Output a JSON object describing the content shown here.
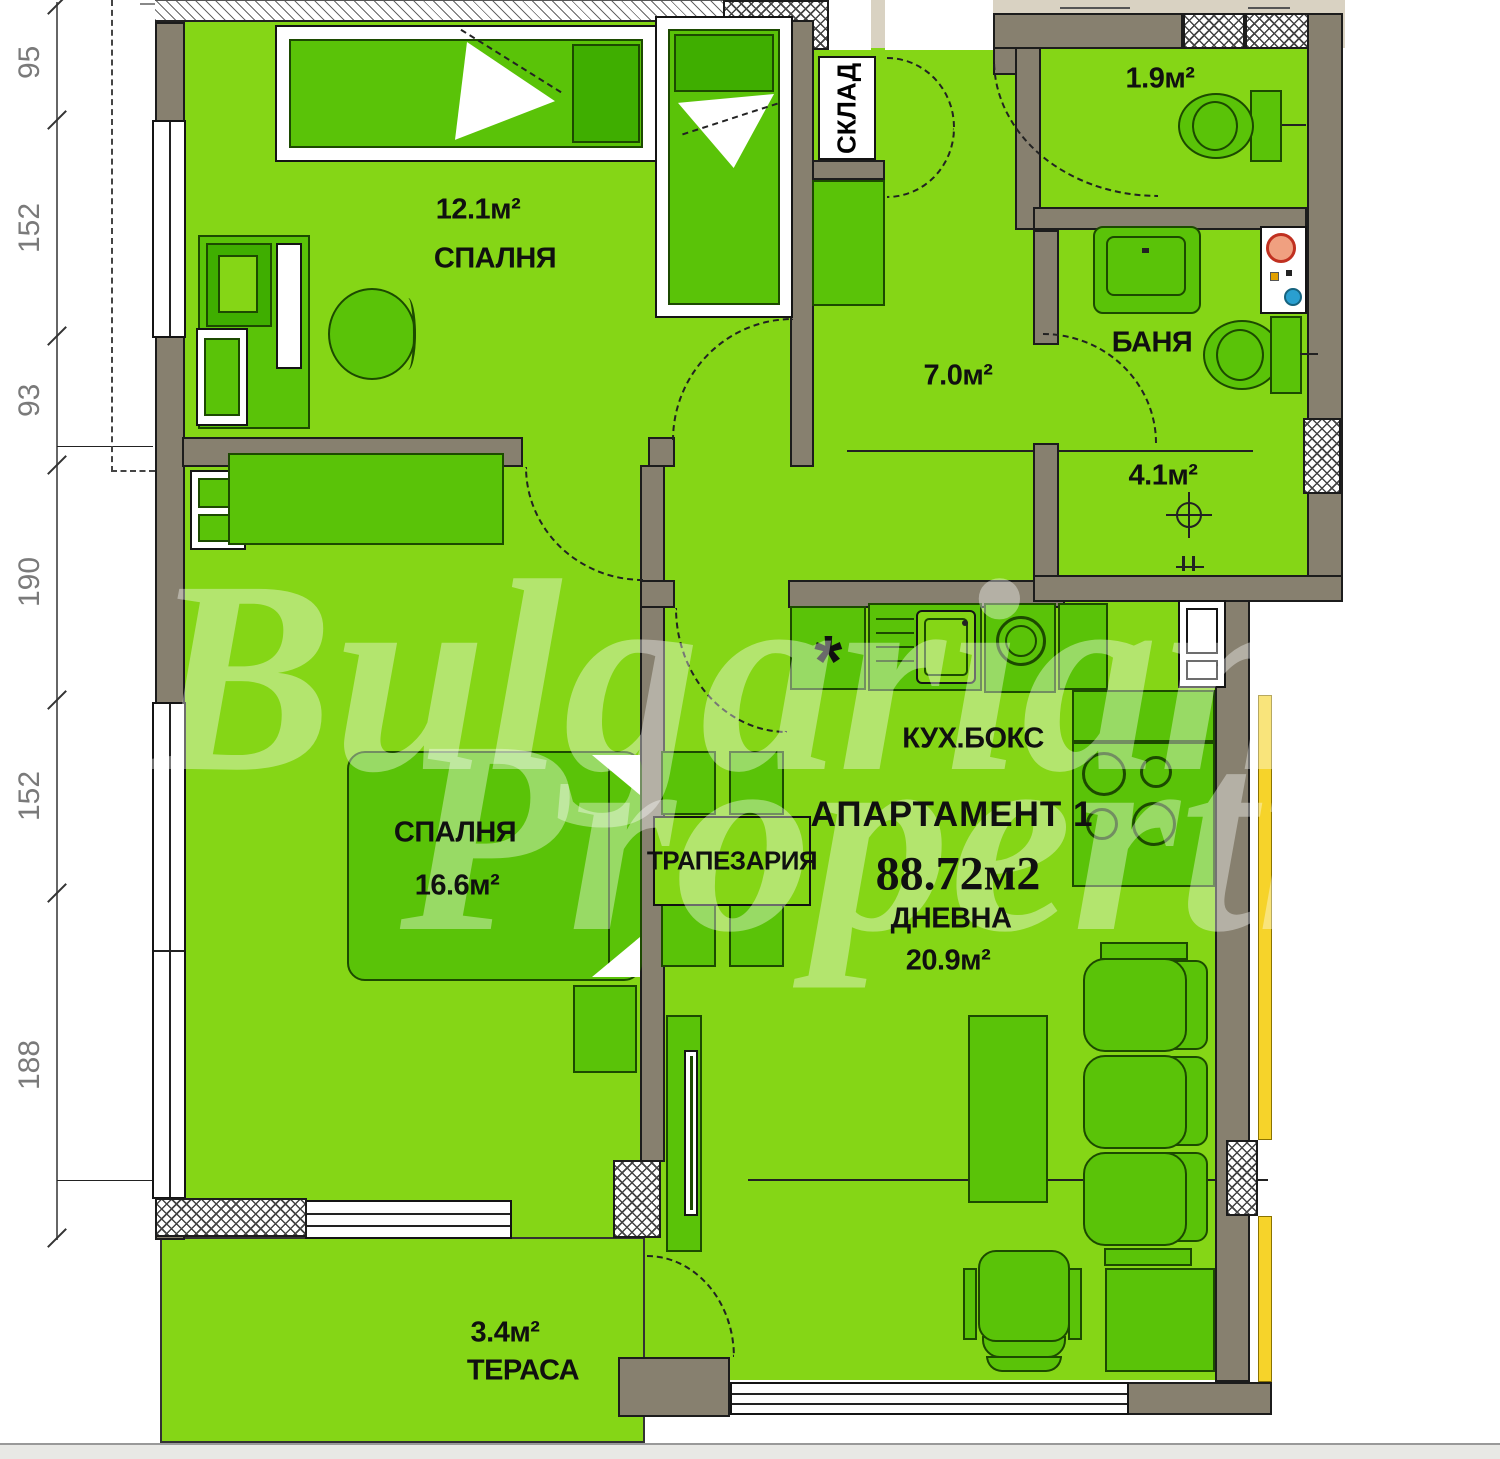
{
  "title": "АПАРТАМЕНТ 1",
  "total_area": "88.72м2",
  "rooms": {
    "bedroom1": {
      "name": "СПАЛНЯ",
      "area": "12.1м²"
    },
    "bedroom2": {
      "name": "СПАЛНЯ",
      "area": "16.6м²"
    },
    "living": {
      "name": "ДНЕВНА",
      "area": "20.9м²"
    },
    "dining": {
      "name": "ТРАПЕЗАРИЯ"
    },
    "kitchen": {
      "name": "КУХ.БОКС"
    },
    "bathroom": {
      "name": "БАНЯ",
      "area": "4.1м²"
    },
    "wc": {
      "area": "1.9м²"
    },
    "hall": {
      "area": "7.0м²"
    },
    "storage": {
      "name": "СКЛАД"
    },
    "terrace": {
      "name": "ТЕРАСА",
      "area": "3.4м²"
    }
  },
  "dimensions_left": [
    "95",
    "152",
    "93",
    "190",
    "152",
    "188"
  ],
  "watermark": {
    "line1": "Bulgarian",
    "line2": "Properties"
  },
  "symbols": {
    "cooktop": "*"
  },
  "colors": {
    "floor_green": "#85d616",
    "furniture_green": "#5ac308",
    "dark_green": "#3fae00",
    "wall_gray": "#87806f",
    "corridor_beige": "#d9d2c2",
    "accent_yellow": "#f6d32a"
  }
}
